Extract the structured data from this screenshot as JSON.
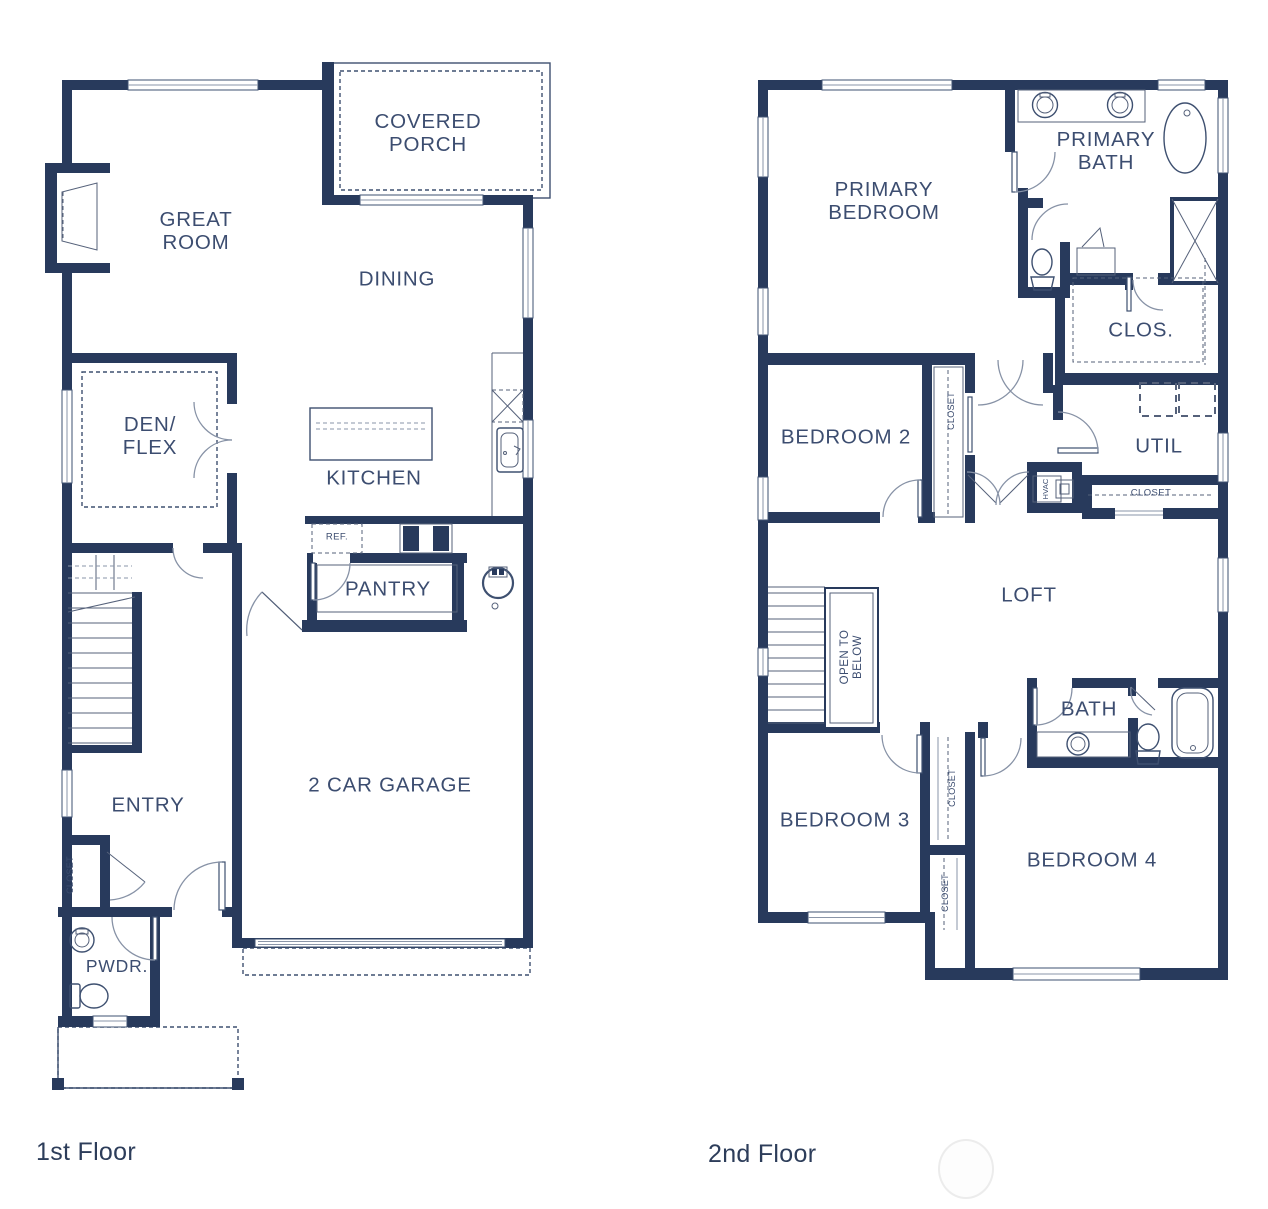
{
  "colors": {
    "wall": "#283a5c",
    "thin_line": "#3e5070",
    "door_arc": "#8792a6",
    "label_text": "#3c4d70",
    "caption_text": "#2d3d5a",
    "background": "#ffffff"
  },
  "floor1": {
    "caption": "1st Floor",
    "rooms": {
      "covered_porch": "COVERED\nPORCH",
      "great_room": "GREAT\nROOM",
      "dining": "DINING",
      "den_flex": "DEN/\nFLEX",
      "kitchen": "KITCHEN",
      "pantry": "PANTRY",
      "ref": "REF.",
      "garage": "2 CAR GARAGE",
      "entry": "ENTRY",
      "closet": "CLOSET",
      "pwdr": "PWDR."
    }
  },
  "floor2": {
    "caption": "2nd Floor",
    "rooms": {
      "primary_bedroom": "PRIMARY\nBEDROOM",
      "primary_bath": "PRIMARY\nBATH",
      "clos": "CLOS.",
      "bedroom2": "BEDROOM 2",
      "util": "UTIL",
      "closet_hall": "CLOSET",
      "hvac": "HVAC",
      "loft": "LOFT",
      "open_to_below": "OPEN TO\nBELOW",
      "bath": "BATH",
      "bedroom3": "BEDROOM 3",
      "bedroom4": "BEDROOM 4",
      "closet_bedroom2": "CLOSET",
      "closet_bedroom3": "CLOSET",
      "closet_bedroom4": "CLOSET"
    }
  }
}
